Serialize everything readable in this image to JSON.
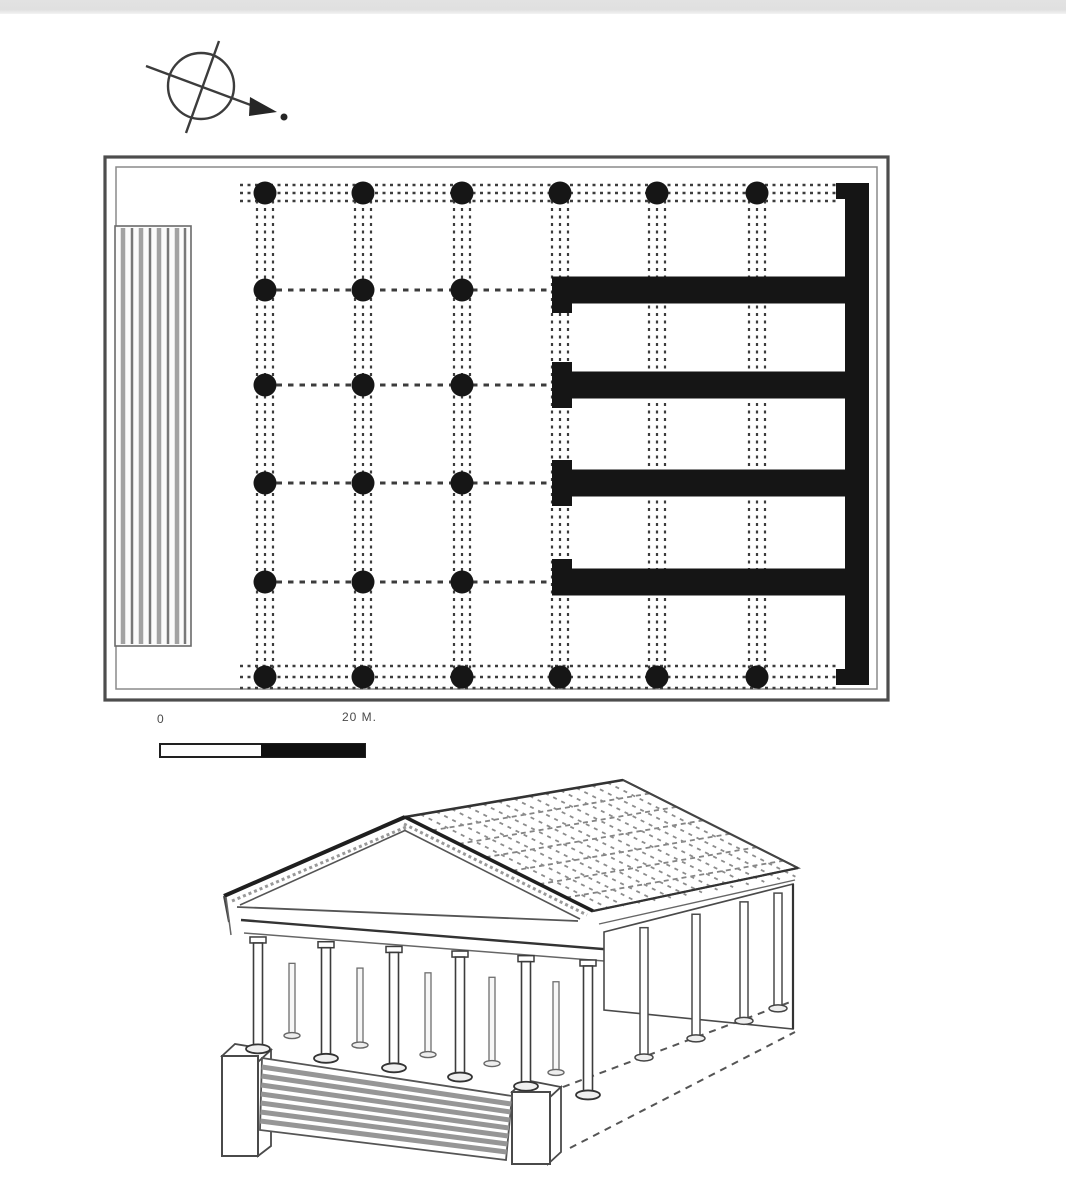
{
  "labels": {
    "scale_zero": "0",
    "scale_right": "20 M."
  },
  "colors": {
    "ink": "#1c1c1c",
    "wall": "#151515",
    "border": "#4d4d4d",
    "border_inner": "#8a8a8a",
    "dash": "#3c3c3c",
    "line": "#444444",
    "light_line": "#666666",
    "hatch_gray": "#969696",
    "stair_gray": "#a2a2a2",
    "stair_dark": "#787878",
    "tile_gray": "#8c8c8c",
    "strip": "#e2e2e2",
    "paper": "#ffffff"
  },
  "plan": {
    "outer": {
      "x": 105,
      "y": 157,
      "w": 783,
      "h": 543
    },
    "inner": {
      "x": 116,
      "y": 167,
      "w": 761,
      "h": 522
    },
    "stairs": {
      "x": 115,
      "y": 226,
      "w": 76,
      "h": 420,
      "line_xs": [
        123,
        132,
        141,
        150,
        159,
        168,
        177,
        185
      ]
    },
    "grid": {
      "col_xs": [
        265,
        363,
        462,
        560,
        657,
        757
      ],
      "row_ys": [
        193,
        290,
        385,
        483,
        582,
        677
      ],
      "dot_radius": 11.5,
      "full_height_cols": 3,
      "band_offsets": [
        -8,
        0,
        8
      ]
    },
    "edge_bands": {
      "top_ys": [
        185,
        193,
        201
      ],
      "bottom_ys": [
        666,
        677,
        688
      ],
      "x1": 240,
      "x2": 836
    },
    "row_dashes": {
      "ys": [
        290,
        385,
        483,
        582
      ],
      "x1": 265,
      "x2": 548
    },
    "walls": {
      "back": {
        "x": 845,
        "y": 183,
        "w": 24,
        "h": 502
      },
      "stubs": [
        {
          "x": 836,
          "y": 183,
          "w": 33,
          "h": 16
        },
        {
          "x": 836,
          "y": 669,
          "w": 33,
          "h": 16
        }
      ],
      "cross": {
        "x": 552,
        "w": 317,
        "ys": [
          276.5,
          371.5,
          469.5,
          568.5
        ],
        "h": 27
      },
      "front": {
        "x": 552,
        "w": 20,
        "segments": [
          [
            303.5,
            313
          ],
          [
            362,
            371.5
          ],
          [
            398.5,
            408
          ],
          [
            460,
            469.5
          ],
          [
            496.5,
            506
          ],
          [
            559,
            568.5
          ]
        ]
      }
    }
  },
  "compass": {
    "cx": 201,
    "cy": 86,
    "r": 33,
    "axis": [
      [
        219,
        41
      ],
      [
        186,
        133
      ]
    ],
    "arrow_line": [
      [
        146,
        66
      ],
      [
        256,
        107
      ]
    ],
    "arrow_head": [
      [
        250,
        97
      ],
      [
        277,
        112
      ],
      [
        249,
        116
      ]
    ],
    "dot": {
      "cx": 284,
      "cy": 117,
      "r": 3.5
    }
  },
  "scalebar": {
    "bar": {
      "x": 160,
      "y": 744,
      "w": 205,
      "h": 13
    },
    "filled_from": 261
  },
  "recon": {
    "roof": {
      "apex": [
        405,
        817
      ],
      "back_apex": [
        623,
        780
      ],
      "back_eave": [
        798,
        868
      ],
      "front_right_eave": [
        593,
        911
      ],
      "left_eave": [
        224,
        896
      ],
      "pediment": [
        [
          405,
          817
        ],
        [
          224,
          896
        ],
        [
          583,
          915
        ]
      ],
      "rake_left_inner": [
        [
          240,
          905
        ],
        [
          406,
          830
        ]
      ],
      "rake_right_inner": [
        [
          404,
          830
        ],
        [
          580,
          919
        ]
      ],
      "rake_left_hatch": [
        [
          232,
          901
        ],
        [
          406,
          827
        ]
      ],
      "rake_right_hatch": [
        [
          404,
          824
        ],
        [
          587,
          915
        ]
      ],
      "eave_tick": [
        [
          224,
          896
        ],
        [
          229,
          922
        ]
      ],
      "pediment_base": [
        [
          237,
          907
        ],
        [
          578,
          921
        ]
      ],
      "tile_rows": 6,
      "tile_cols": 13
    },
    "entablature": {
      "top": [
        [
          241,
          920
        ],
        [
          615,
          950
        ]
      ],
      "bottom": [
        [
          244,
          933
        ],
        [
          617,
          962
        ]
      ]
    },
    "flank": {
      "eave": [
        [
          593,
          911
        ],
        [
          798,
          868
        ]
      ],
      "fascia": [
        [
          599,
          924
        ],
        [
          795,
          880
        ]
      ]
    },
    "wall_poly": [
      [
        604,
        932
      ],
      [
        793,
        884
      ],
      [
        793,
        1029
      ],
      [
        604,
        1010
      ]
    ],
    "corner_line": [
      [
        793,
        884
      ],
      [
        793,
        1029
      ]
    ],
    "front_columns": {
      "xs": [
        258,
        326,
        394,
        460,
        526,
        588
      ],
      "w": 9,
      "top_line": [
        [
          244,
          936
        ],
        [
          617,
          962
        ]
      ],
      "bot_line": [
        [
          252,
          1046
        ],
        [
          610,
          1096
        ]
      ]
    },
    "inner_columns": {
      "xs": [
        292,
        360,
        428,
        492,
        556
      ],
      "w": 6,
      "dy_top": 24,
      "dy_bot": -16
    },
    "side_columns": {
      "xs": [
        644,
        696,
        744,
        778
      ],
      "w": 8,
      "top_line": [
        [
          604,
          938
        ],
        [
          790,
          890
        ]
      ],
      "bot_line": [
        [
          566,
          1086
        ],
        [
          790,
          1004
        ]
      ]
    },
    "podium": {
      "left_block": {
        "front": {
          "x": 222,
          "y": 1056,
          "w": 36,
          "h": 100
        },
        "top": [
          [
            222,
            1056
          ],
          [
            235,
            1044
          ],
          [
            271,
            1050
          ],
          [
            258,
            1062
          ]
        ],
        "side": [
          [
            258,
            1062
          ],
          [
            271,
            1050
          ],
          [
            271,
            1146
          ],
          [
            258,
            1156
          ]
        ]
      },
      "right_block": {
        "front": {
          "x": 512,
          "y": 1092,
          "w": 38,
          "h": 72
        },
        "top": [
          [
            512,
            1092
          ],
          [
            525,
            1080
          ],
          [
            561,
            1087
          ],
          [
            548,
            1099
          ]
        ],
        "side": [
          [
            548,
            1099
          ],
          [
            561,
            1087
          ],
          [
            561,
            1152
          ],
          [
            548,
            1164
          ]
        ]
      },
      "stairs": {
        "poly": [
          [
            262,
            1058
          ],
          [
            512,
            1096
          ],
          [
            506,
            1160
          ],
          [
            260,
            1130
          ]
        ],
        "hatch_n": 7
      },
      "dash_top": [
        [
          563,
          1087
        ],
        [
          793,
          1001
        ]
      ],
      "dash_bot": [
        [
          570,
          1148
        ],
        [
          795,
          1032
        ]
      ],
      "corner_tick": [
        [
          226,
          897
        ],
        [
          231,
          935
        ]
      ]
    }
  }
}
